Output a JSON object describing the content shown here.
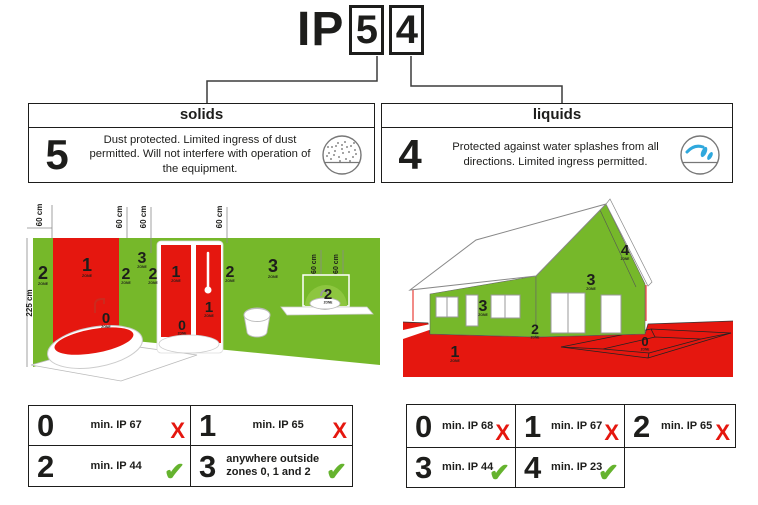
{
  "title": {
    "prefix": "IP",
    "solids_digit": "5",
    "liquids_digit": "4"
  },
  "info_boxes": {
    "solids": {
      "header": "solids",
      "digit": "5",
      "description": "Dust protected. Limited ingress of dust permitted. Will not interfere with operation of the equipment.",
      "icon": "dust-circle-icon"
    },
    "liquids": {
      "header": "liquids",
      "digit": "4",
      "description": "Protected against water splashes from all directions. Limited ingress permitted.",
      "icon": "water-splash-icon"
    }
  },
  "bathroom": {
    "height_label": "225 cm",
    "dim_label": "60 cm",
    "zone_word": "ZONE",
    "labels": {
      "left_strip": "2",
      "tub_wall": "1",
      "tub": "0",
      "mid_strip": "2",
      "corner_upper": "3",
      "corner_lower": "2",
      "shower_left": "1",
      "shower_tray": "0",
      "shower_right": "1",
      "right_strip": "2",
      "main_wall": "3",
      "basin": "2"
    }
  },
  "house": {
    "zone_word": "ZONE",
    "labels": {
      "side_wall": "3",
      "base": "2",
      "gable_wall": "3",
      "roof_edge": "4",
      "ground": "1",
      "pit": "0"
    }
  },
  "zone_tables": {
    "bathroom": [
      {
        "zone": "0",
        "requirement": "min. IP 67",
        "allowed": false
      },
      {
        "zone": "1",
        "requirement": "min. IP 65",
        "allowed": false
      },
      {
        "zone": "2",
        "requirement": "min. IP 44",
        "allowed": true
      },
      {
        "zone": "3",
        "requirement": "anywhere outside zones 0, 1 and 2",
        "allowed": true
      }
    ],
    "house": [
      {
        "zone": "0",
        "requirement": "min. IP 68",
        "allowed": false
      },
      {
        "zone": "1",
        "requirement": "min. IP 67",
        "allowed": false
      },
      {
        "zone": "2",
        "requirement": "min. IP 65",
        "allowed": false
      },
      {
        "zone": "3",
        "requirement": "min. IP 44",
        "allowed": true
      },
      {
        "zone": "4",
        "requirement": "min. IP 23",
        "allowed": true
      }
    ]
  },
  "marks": {
    "pass": "✔",
    "fail": "X"
  },
  "colors": {
    "zone_green": "#76b82a",
    "zone_light_green": "#8dc63f",
    "zone_red": "#e5170f",
    "water_blue": "#2fa8dd",
    "check_green": "#65b32e",
    "cross_red": "#e5170f",
    "line_dark": "#1d1d1b"
  }
}
